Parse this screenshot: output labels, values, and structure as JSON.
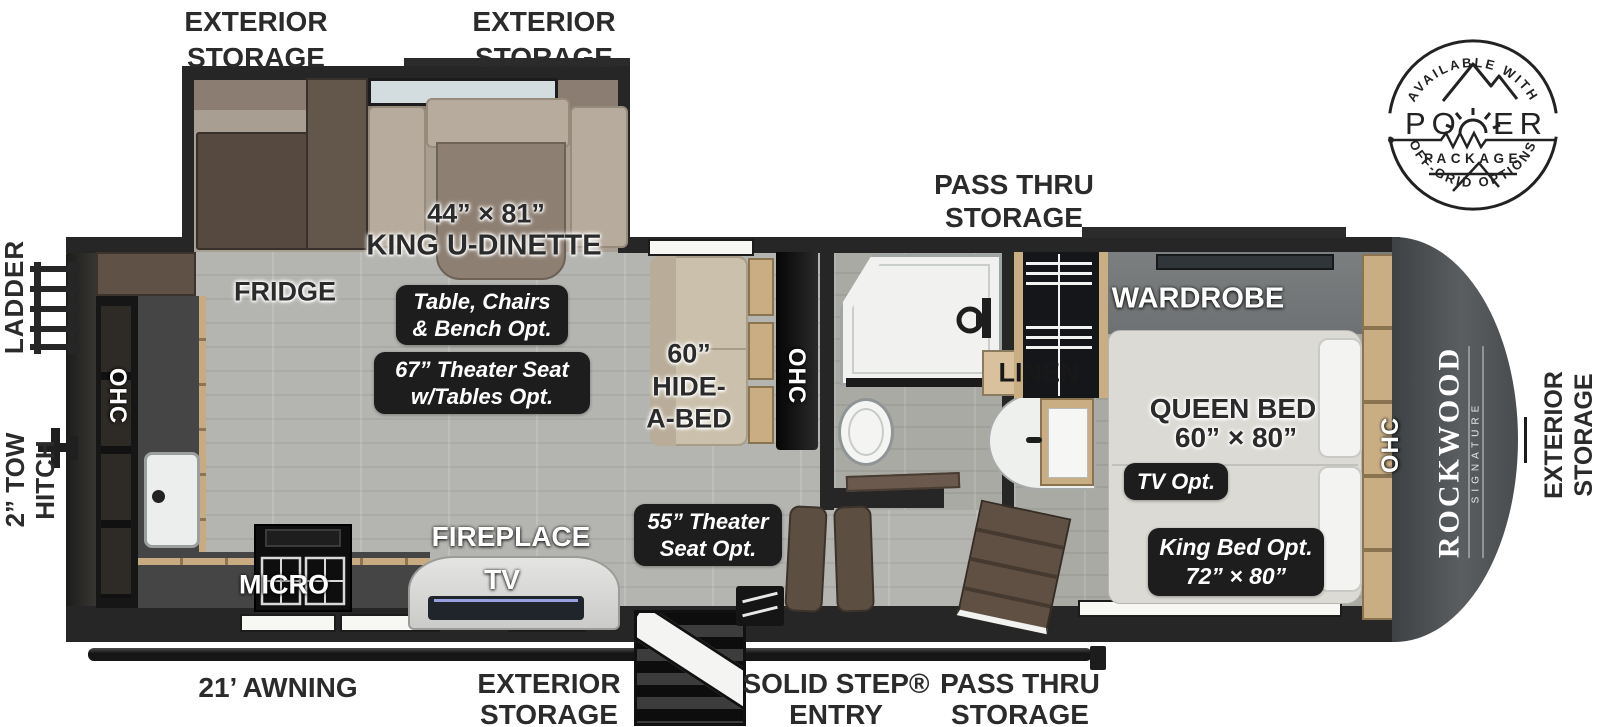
{
  "power_badge": {
    "arc_top": "AVAILABLE WITH",
    "word_prefix": "PO",
    "word_suffix": "ER",
    "package": "PACKAGE",
    "arc_bottom": "OFF-GRID OPTIONS"
  },
  "brand": {
    "name": "ROCKWOOD",
    "series": "SIGNATURE"
  },
  "exterior": {
    "storage_top_left_l1": "EXTERIOR",
    "storage_top_left_l2": "STORAGE",
    "storage_top_mid_l1": "EXTERIOR",
    "storage_top_mid_l2": "STORAGE",
    "pass_thru_top_l1": "PASS THRU",
    "pass_thru_top_l2": "STORAGE",
    "ladder": "LADDER",
    "tow_hitch_l1": "2” TOW",
    "tow_hitch_l2": "HITCH",
    "storage_right_l1": "EXTERIOR",
    "storage_right_l2": "STORAGE",
    "awning": "21’ AWNING",
    "storage_bottom_l1": "EXTERIOR",
    "storage_bottom_l2": "STORAGE",
    "entry_l1": "SOLID STEP®",
    "entry_l2": "ENTRY",
    "pass_thru_bottom_l1": "PASS THRU",
    "pass_thru_bottom_l2": "STORAGE"
  },
  "interior": {
    "fridge": "FRIDGE",
    "dinette_size": "44” × 81”",
    "dinette_name": "KING U-DINETTE",
    "ohc": "OHC",
    "micro": "MICRO",
    "fireplace": "FIREPLACE",
    "tv": "TV",
    "hide_a_bed_l1": "60”",
    "hide_a_bed_l2": "HIDE-",
    "hide_a_bed_l3": "A-BED",
    "linen": "LINEN",
    "wardrobe": "WARDROBE",
    "queen_bed_l1": "QUEEN BED",
    "queen_bed_l2": "60” × 80”"
  },
  "options": {
    "table_l1": "Table, Chairs",
    "table_l2": "& Bench Opt.",
    "theater67_l1": "67” Theater Seat",
    "theater67_l2": "w/Tables Opt.",
    "theater55_l1": "55” Theater",
    "theater55_l2": "Seat Opt.",
    "tv_opt": "TV Opt.",
    "king_l1": "King Bed Opt.",
    "king_l2": "72” × 80”"
  },
  "colors": {
    "wall": "#262626",
    "floor": "#b2b3ae",
    "front_cap": "#4b4e50",
    "wood": "#c9ad83",
    "badge": "#1d1d1d",
    "tv_accent": "#97a0e0"
  }
}
